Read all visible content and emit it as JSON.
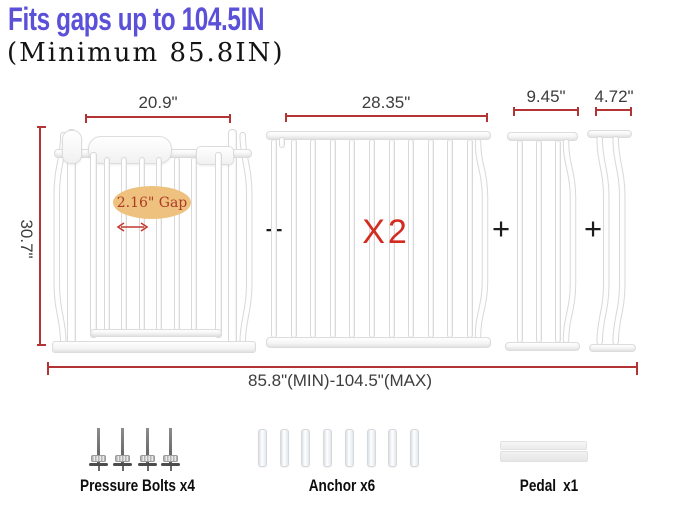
{
  "title": {
    "text": "Fits gaps up to 104.5IN"
  },
  "subtitle": {
    "text": "(Minimum 85.8IN)"
  },
  "dimensions": {
    "gate_width": "20.9\"",
    "gate_height": "30.7\"",
    "extension_large_width": "28.35\"",
    "extension_medium_width": "9.45\"",
    "extension_small_width": "4.72\"",
    "total_range": "85.8\"(MIN)-104.5\"(MAX)",
    "bar_gap": "2.16\" Gap"
  },
  "quantity_large_extension": "X2",
  "plus_sign": "+",
  "structure": {
    "main_gate_bars": 6,
    "extension_large_bars": 11,
    "extension_medium_bars": 3,
    "extension_small_wavy_bars": 2
  },
  "accessories": {
    "bolts": {
      "label": "Pressure Bolts x4",
      "count": 4
    },
    "anchors": {
      "label": "Anchor x6",
      "count": 8
    },
    "pedal": {
      "label": "Pedal x1",
      "count": 1
    }
  },
  "colors": {
    "title": "#5b50d8",
    "dimension_line": "#b23434",
    "red_accent": "#d32b1f",
    "ellipse_bg": "#eec27e",
    "ellipse_text": "#ae3a28"
  }
}
